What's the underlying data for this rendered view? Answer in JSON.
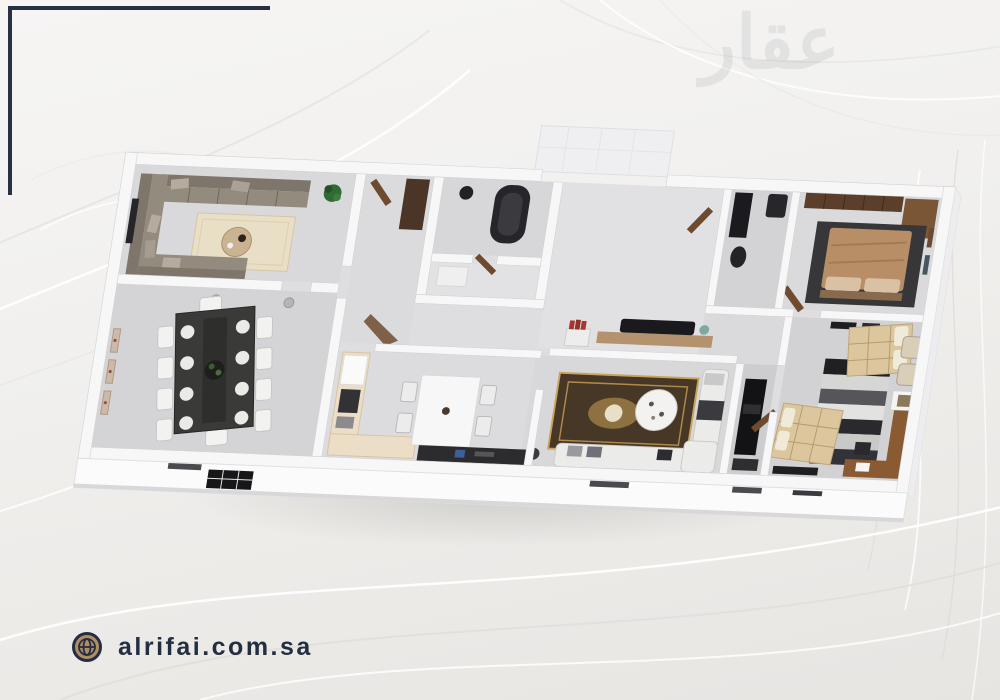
{
  "watermark": {
    "text": "عقار",
    "color": "#8d9297"
  },
  "footer": {
    "website": "alrifai.com.sa",
    "text_color": "#232e42",
    "globe_icon": "globe-icon",
    "globe_fill": "#b08d63",
    "globe_ring": "#232e42"
  },
  "decor": {
    "corner_frame_color": "#273142",
    "background_top": "#f6f5f4",
    "background_bottom": "#e7e5e2"
  },
  "floor_plan": {
    "type": "3d-rendered-apartment-floor-plan",
    "view": "top-down isometric",
    "wall_color": "#f7f7f8",
    "floor_color": "#dcdcde",
    "rooms": [
      "majlis-living-room",
      "dining-room",
      "corridor",
      "bathroom-with-tub",
      "vestibule",
      "kitchen",
      "entrance-hall",
      "family-living-room",
      "media-room",
      "bathroom-2",
      "master-bedroom",
      "kids-bedroom"
    ]
  }
}
